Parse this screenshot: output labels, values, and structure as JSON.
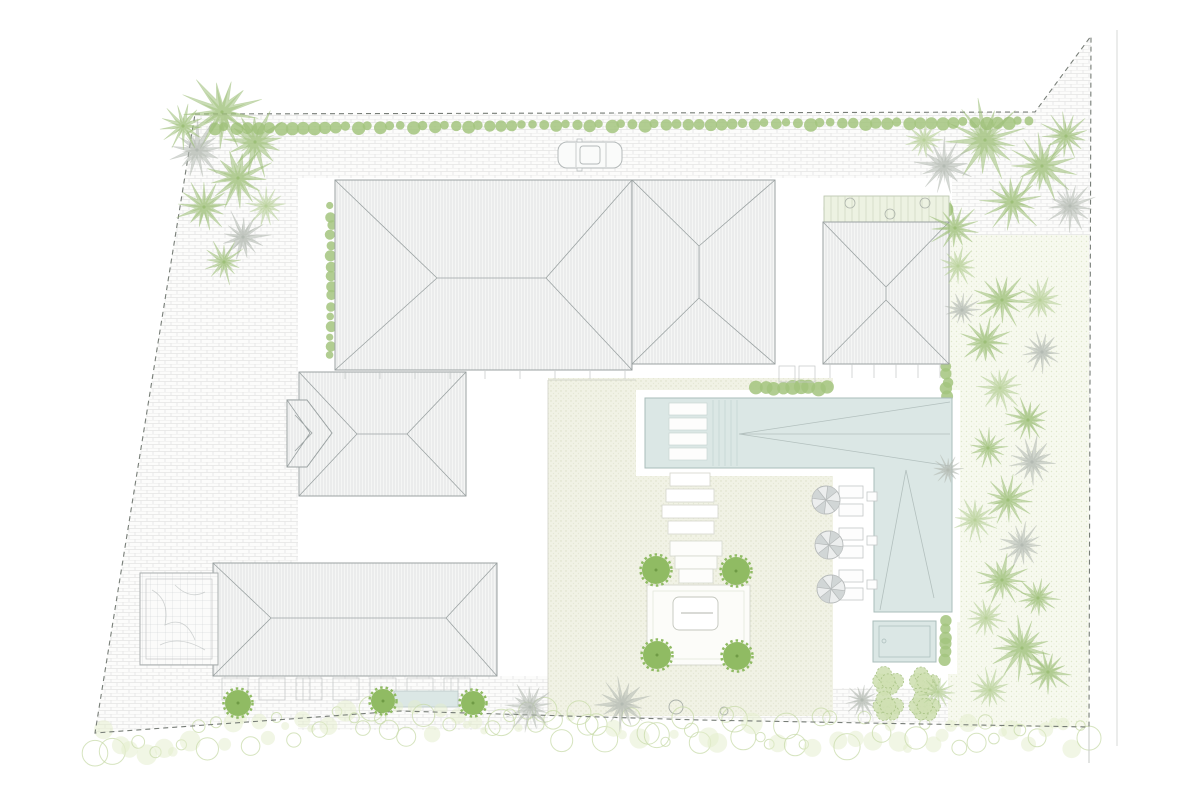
{
  "palette": {
    "background": "#ffffff",
    "paving_line": "#e4e4e4",
    "roof_fill": "#f5f6f5",
    "roof_hatch": "#d9dcdc",
    "roof_outline": "#9ba2a2",
    "boundary_dash": "#777d77",
    "road_line": "#d7dad7",
    "pool_water": "#dbe7e5",
    "pool_outline": "#a9bcba",
    "pool_canopy_line": "#b3c0be",
    "courtyard_ground": "#f1f2e5",
    "garden_ground": "#f7f9ef",
    "hedge_green": "#a3c47e",
    "tree_green": "#90bb63",
    "tree_core": "#6f9b45",
    "palm_green": "#9dbf78",
    "palm_light": "#b7d098",
    "palm_gray": "#b3bab2",
    "shrub_fill": "#cfe0b2",
    "shrub_line": "#a9c386",
    "veg_outline": "#c8dba9",
    "veg_fill": "#e3eecb",
    "furniture_line": "#c3c7c7",
    "parasol_fill": "#eceeee",
    "parasol_shade": "#cdd1d1",
    "parasol_line": "#b5b9b9",
    "car_line": "#b4b9b9"
  },
  "plants": {
    "palms": [
      {
        "x": 222,
        "y": 112,
        "r": 40,
        "tone": "green"
      },
      {
        "x": 255,
        "y": 142,
        "r": 34,
        "tone": "green"
      },
      {
        "x": 197,
        "y": 150,
        "r": 30,
        "tone": "gray"
      },
      {
        "x": 238,
        "y": 178,
        "r": 34,
        "tone": "green"
      },
      {
        "x": 204,
        "y": 207,
        "r": 28,
        "tone": "green"
      },
      {
        "x": 243,
        "y": 237,
        "r": 26,
        "tone": "gray"
      },
      {
        "x": 183,
        "y": 126,
        "r": 24,
        "tone": "green"
      },
      {
        "x": 224,
        "y": 262,
        "r": 22,
        "tone": "green"
      },
      {
        "x": 266,
        "y": 206,
        "r": 20,
        "tone": "light"
      },
      {
        "x": 985,
        "y": 140,
        "r": 40,
        "tone": "green"
      },
      {
        "x": 1042,
        "y": 166,
        "r": 34,
        "tone": "green"
      },
      {
        "x": 944,
        "y": 166,
        "r": 28,
        "tone": "gray"
      },
      {
        "x": 1012,
        "y": 202,
        "r": 32,
        "tone": "green"
      },
      {
        "x": 1066,
        "y": 136,
        "r": 26,
        "tone": "green"
      },
      {
        "x": 924,
        "y": 140,
        "r": 22,
        "tone": "light"
      },
      {
        "x": 1070,
        "y": 206,
        "r": 26,
        "tone": "gray"
      },
      {
        "x": 955,
        "y": 228,
        "r": 26,
        "tone": "green"
      },
      {
        "x": 958,
        "y": 266,
        "r": 20,
        "tone": "light"
      },
      {
        "x": 1002,
        "y": 300,
        "r": 28,
        "tone": "green"
      },
      {
        "x": 1040,
        "y": 300,
        "r": 24,
        "tone": "light"
      },
      {
        "x": 985,
        "y": 342,
        "r": 26,
        "tone": "green"
      },
      {
        "x": 1042,
        "y": 352,
        "r": 22,
        "tone": "gray"
      },
      {
        "x": 1000,
        "y": 388,
        "r": 24,
        "tone": "light"
      },
      {
        "x": 1028,
        "y": 420,
        "r": 24,
        "tone": "green"
      },
      {
        "x": 988,
        "y": 448,
        "r": 20,
        "tone": "green"
      },
      {
        "x": 1032,
        "y": 462,
        "r": 26,
        "tone": "gray"
      },
      {
        "x": 1008,
        "y": 500,
        "r": 26,
        "tone": "green"
      },
      {
        "x": 975,
        "y": 520,
        "r": 22,
        "tone": "light"
      },
      {
        "x": 1022,
        "y": 545,
        "r": 24,
        "tone": "gray"
      },
      {
        "x": 1002,
        "y": 580,
        "r": 26,
        "tone": "green"
      },
      {
        "x": 1038,
        "y": 598,
        "r": 22,
        "tone": "green"
      },
      {
        "x": 986,
        "y": 618,
        "r": 20,
        "tone": "light"
      },
      {
        "x": 1022,
        "y": 648,
        "r": 32,
        "tone": "green"
      },
      {
        "x": 1048,
        "y": 672,
        "r": 24,
        "tone": "green"
      },
      {
        "x": 990,
        "y": 690,
        "r": 22,
        "tone": "light"
      },
      {
        "x": 938,
        "y": 692,
        "r": 18,
        "tone": "light"
      },
      {
        "x": 962,
        "y": 310,
        "r": 18,
        "tone": "gray"
      },
      {
        "x": 948,
        "y": 470,
        "r": 16,
        "tone": "gray"
      },
      {
        "x": 530,
        "y": 707,
        "r": 24,
        "tone": "gray"
      },
      {
        "x": 622,
        "y": 704,
        "r": 28,
        "tone": "gray"
      },
      {
        "x": 862,
        "y": 700,
        "r": 18,
        "tone": "gray"
      }
    ],
    "round_trees": [
      {
        "x": 238,
        "y": 703,
        "r": 13
      },
      {
        "x": 383,
        "y": 701,
        "r": 12
      },
      {
        "x": 473,
        "y": 703,
        "r": 12
      },
      {
        "x": 656,
        "y": 570,
        "r": 14
      },
      {
        "x": 736,
        "y": 571,
        "r": 14
      },
      {
        "x": 657,
        "y": 655,
        "r": 14
      },
      {
        "x": 737,
        "y": 656,
        "r": 14
      }
    ],
    "shrub_clusters": [
      {
        "x": 888,
        "y": 681
      },
      {
        "x": 925,
        "y": 681
      },
      {
        "x": 888,
        "y": 706
      },
      {
        "x": 925,
        "y": 706
      }
    ],
    "hedges": [
      {
        "x1": 214,
        "y1": 128,
        "x2": 1030,
        "y2": 122,
        "r": 5.5,
        "step": 11
      },
      {
        "x1": 331,
        "y1": 206,
        "x2": 331,
        "y2": 356,
        "r": 4.5,
        "step": 10
      },
      {
        "x1": 757,
        "y1": 388,
        "x2": 826,
        "y2": 388,
        "r": 6,
        "step": 9
      },
      {
        "x1": 947,
        "y1": 368,
        "x2": 947,
        "y2": 396,
        "r": 5,
        "step": 8
      },
      {
        "x1": 946,
        "y1": 622,
        "x2": 946,
        "y2": 660,
        "r": 5,
        "step": 8
      },
      {
        "x1": 830,
        "y1": 208,
        "x2": 944,
        "y2": 208,
        "r": 7,
        "step": 12
      }
    ]
  },
  "pool_furniture": {
    "parasols": [
      {
        "x": 826,
        "y": 500
      },
      {
        "x": 829,
        "y": 545
      },
      {
        "x": 831,
        "y": 589
      }
    ],
    "loungers": [
      {
        "x": 839,
        "y": 486
      },
      {
        "x": 839,
        "y": 504
      },
      {
        "x": 839,
        "y": 528
      },
      {
        "x": 839,
        "y": 546
      },
      {
        "x": 839,
        "y": 570
      },
      {
        "x": 839,
        "y": 588
      }
    ],
    "side_tables": [
      {
        "x": 867,
        "y": 492
      },
      {
        "x": 867,
        "y": 536
      },
      {
        "x": 867,
        "y": 580
      }
    ]
  },
  "car": {
    "x": 558,
    "y": 142,
    "w": 64,
    "h": 26
  }
}
